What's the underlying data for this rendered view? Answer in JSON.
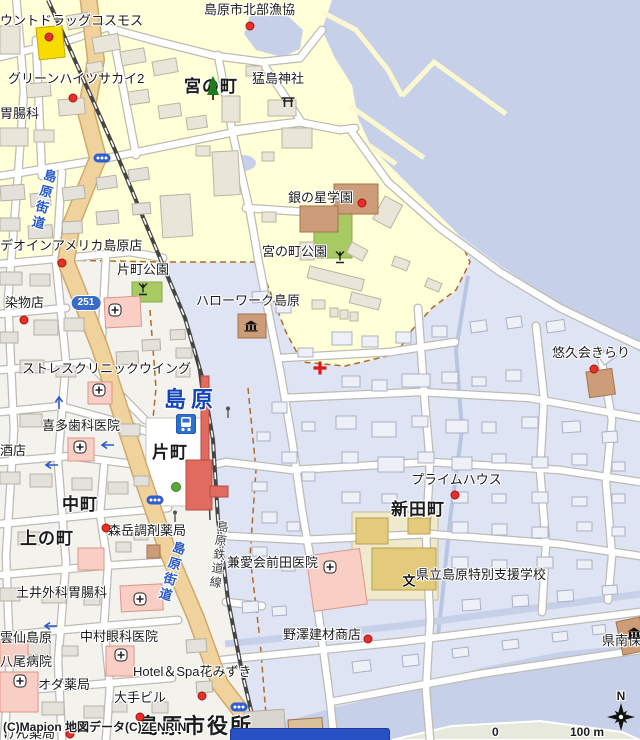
{
  "map": {
    "attribution": "(C)Mapion 地図データ(C)ZENRIN",
    "scale": {
      "zero": "0",
      "label": "100 m",
      "north": "N"
    },
    "route_shield": "251",
    "labels": [
      {
        "t": "ウントドラッグコスモス",
        "x": 0,
        "y": 14,
        "s": "poi"
      },
      {
        "t": "グリーンハイツサカイ2",
        "x": 8,
        "y": 72,
        "s": "poi"
      },
      {
        "t": "胃腸科",
        "x": 0,
        "y": 107,
        "s": "poi"
      },
      {
        "t": "島原市北部漁協",
        "x": 204,
        "y": 3,
        "s": "poi"
      },
      {
        "t": "宮の町",
        "x": 184,
        "y": 78,
        "s": "town"
      },
      {
        "t": "猛島神社",
        "x": 252,
        "y": 72,
        "s": "poi"
      },
      {
        "t": "銀の星学園",
        "x": 288,
        "y": 191,
        "s": "poi"
      },
      {
        "t": "宮の町公園",
        "x": 262,
        "y": 245,
        "s": "poi"
      },
      {
        "t": "片町公園",
        "x": 117,
        "y": 263,
        "s": "poi"
      },
      {
        "t": "ハローワーク島原",
        "x": 196,
        "y": 294,
        "s": "poi"
      },
      {
        "t": "デオインアメリカ島原店",
        "x": 0,
        "y": 239,
        "s": "poi"
      },
      {
        "t": "染物店",
        "x": 5,
        "y": 296,
        "s": "poi"
      },
      {
        "t": "ストレスクリニックウイング",
        "x": 22,
        "y": 362,
        "s": "poi"
      },
      {
        "t": "喜多歯科医院",
        "x": 42,
        "y": 419,
        "s": "poi"
      },
      {
        "t": "酒店",
        "x": 0,
        "y": 444,
        "s": "poi"
      },
      {
        "t": "島原",
        "x": 164,
        "y": 388,
        "s": "station"
      },
      {
        "t": "片町",
        "x": 152,
        "y": 444,
        "s": "town"
      },
      {
        "t": "中町",
        "x": 62,
        "y": 496,
        "s": "town"
      },
      {
        "t": "上の町",
        "x": 20,
        "y": 530,
        "s": "town"
      },
      {
        "t": "新田町",
        "x": 391,
        "y": 501,
        "s": "town"
      },
      {
        "t": "悠久会きらり",
        "x": 552,
        "y": 346,
        "s": "poi"
      },
      {
        "t": "プライムハウス",
        "x": 411,
        "y": 473,
        "s": "poi"
      },
      {
        "t": "森岳調剤薬局",
        "x": 108,
        "y": 524,
        "s": "poi"
      },
      {
        "t": "兼愛会前田医院",
        "x": 227,
        "y": 556,
        "s": "poi"
      },
      {
        "t": "土井外科胃腸科",
        "x": 16,
        "y": 586,
        "s": "poi"
      },
      {
        "t": "県立島原特別支援学校",
        "x": 416,
        "y": 568,
        "s": "poi"
      },
      {
        "t": "野澤建材商店",
        "x": 283,
        "y": 628,
        "s": "poi"
      },
      {
        "t": "県南保",
        "x": 602,
        "y": 634,
        "s": "poi"
      },
      {
        "t": "中村眼科医院",
        "x": 80,
        "y": 630,
        "s": "poi"
      },
      {
        "t": "雲仙島原",
        "x": 0,
        "y": 631,
        "s": "poi"
      },
      {
        "t": "八尾病院",
        "x": 0,
        "y": 655,
        "s": "poi"
      },
      {
        "t": "オダ薬局",
        "x": 38,
        "y": 678,
        "s": "poi"
      },
      {
        "t": "Hotel＆Spa花みずき",
        "x": 133,
        "y": 665,
        "s": "poi"
      },
      {
        "t": "大手ビル",
        "x": 114,
        "y": 691,
        "s": "poi"
      },
      {
        "t": "けん薬局",
        "x": 3,
        "y": 727,
        "s": "poi"
      },
      {
        "t": "島原市役所",
        "x": 138,
        "y": 716,
        "s": "town-lg"
      },
      {
        "t": "島原街道",
        "x": 36,
        "y": 168,
        "s": "road",
        "r": 14
      },
      {
        "t": "島原街道",
        "x": 164,
        "y": 540,
        "s": "road",
        "r": 16
      },
      {
        "t": "島原鉄道線",
        "x": 212,
        "y": 520,
        "s": "rail",
        "r": 7
      }
    ],
    "markers": [
      {
        "type": "dot",
        "x": 49,
        "y": 37
      },
      {
        "type": "dot",
        "x": 73,
        "y": 98
      },
      {
        "type": "dot",
        "x": 250,
        "y": 26
      },
      {
        "type": "dot",
        "x": 362,
        "y": 203
      },
      {
        "type": "dot",
        "x": 62,
        "y": 263
      },
      {
        "type": "dot",
        "x": 24,
        "y": 320
      },
      {
        "type": "dot",
        "x": 594,
        "y": 369
      },
      {
        "type": "dot",
        "x": 455,
        "y": 495
      },
      {
        "type": "dot",
        "x": 106,
        "y": 528
      },
      {
        "type": "dot",
        "x": 368,
        "y": 639
      },
      {
        "type": "dot",
        "x": 202,
        "y": 696
      },
      {
        "type": "dot",
        "x": 140,
        "y": 717
      },
      {
        "type": "dot",
        "x": 70,
        "y": 734
      },
      {
        "type": "hospital",
        "x": 115,
        "y": 310
      },
      {
        "type": "hospital",
        "x": 99,
        "y": 390
      },
      {
        "type": "hospital",
        "x": 80,
        "y": 447
      },
      {
        "type": "hospital",
        "x": 140,
        "y": 599
      },
      {
        "type": "hospital",
        "x": 121,
        "y": 655
      },
      {
        "type": "hospital",
        "x": 20,
        "y": 681
      },
      {
        "type": "hospital",
        "x": 330,
        "y": 567
      },
      {
        "type": "torii",
        "x": 288,
        "y": 102
      },
      {
        "type": "fountain",
        "x": 143,
        "y": 289
      },
      {
        "type": "fountain",
        "x": 340,
        "y": 257
      },
      {
        "type": "tree",
        "x": 213,
        "y": 88
      },
      {
        "type": "gov",
        "x": 251,
        "y": 326
      },
      {
        "type": "gov",
        "x": 634,
        "y": 633
      },
      {
        "type": "school",
        "x": 409,
        "y": 581,
        "t": "文"
      },
      {
        "type": "train",
        "x": 186,
        "y": 424
      },
      {
        "type": "shield",
        "x": 86,
        "y": 303,
        "t": "251"
      },
      {
        "type": "light",
        "x": 102,
        "y": 158
      },
      {
        "type": "light",
        "x": 155,
        "y": 500
      },
      {
        "type": "light",
        "x": 239,
        "y": 707
      },
      {
        "type": "cross",
        "x": 320,
        "y": 368
      },
      {
        "type": "arrow-left",
        "x": 107,
        "y": 445
      },
      {
        "type": "arrow-left",
        "x": 51,
        "y": 465
      },
      {
        "type": "arrow-left",
        "x": 50,
        "y": 626
      },
      {
        "type": "arrow-up",
        "x": 59,
        "y": 402
      },
      {
        "type": "treedot",
        "x": 176,
        "y": 487
      },
      {
        "type": "pole",
        "x": 228,
        "y": 412
      },
      {
        "type": "pole",
        "x": 175,
        "y": 516
      }
    ]
  }
}
